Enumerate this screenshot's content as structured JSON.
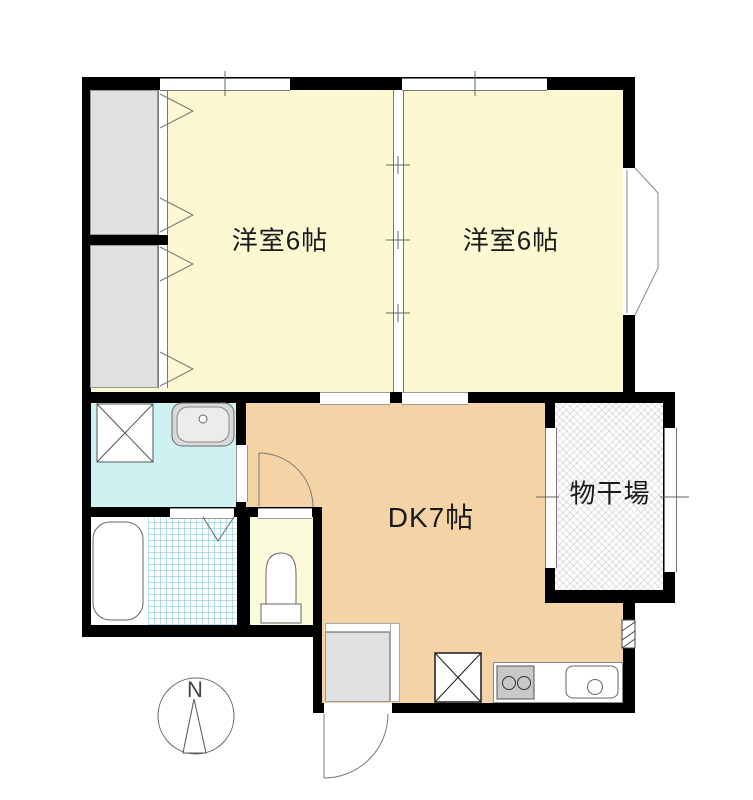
{
  "plan": {
    "type": "apartment-floor-plan",
    "rooms": {
      "bedroom1": {
        "label": "洋室6帖"
      },
      "bedroom2": {
        "label": "洋室6帖"
      },
      "dining_kitchen": {
        "label": "DK7帖"
      },
      "drying_area": {
        "label": "物干場"
      }
    },
    "compass": {
      "north_label": "N"
    },
    "colors": {
      "bedroom_fill": "#FBF8D2",
      "dk_fill": "#F4D3A7",
      "washroom_fill": "#CEF2F1",
      "toilet_fill": "#FBFADA",
      "closet_fill": "#E0E0E0",
      "entrance_fill": "#E0E0E0",
      "wall": "#000000",
      "tile_line": "#78C8DC"
    },
    "icons": {
      "fixtures": [
        "closet-folding-door-icon",
        "sliding-partition-icon",
        "washing-machine-pan-icon",
        "washbasin-icon",
        "bathtub-icon",
        "bifold-bath-door-icon",
        "toilet-icon",
        "hinged-door-arc-icon",
        "entrance-door-arc-icon",
        "refrigerator-space-icon",
        "stove-burners-icon",
        "kitchen-sink-icon",
        "bay-window-icon",
        "pipe-space-icon",
        "north-compass-icon"
      ]
    }
  }
}
